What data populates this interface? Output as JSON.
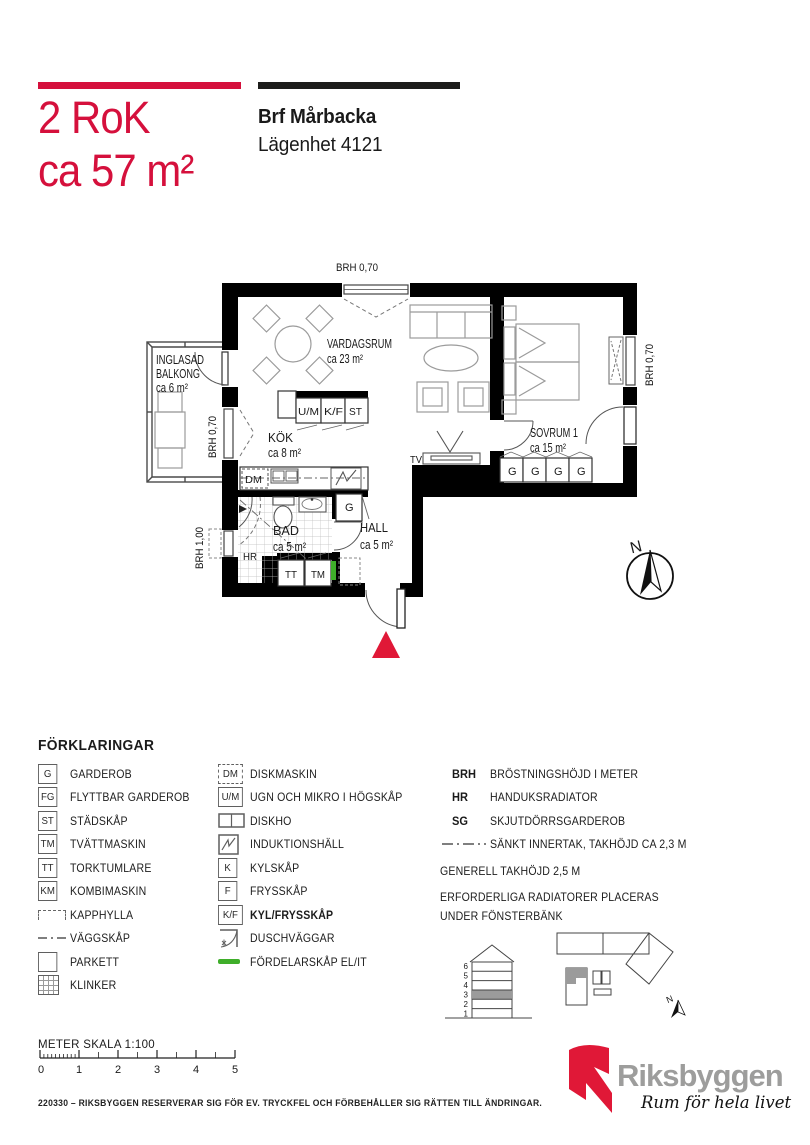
{
  "header": {
    "title_line1": "2 RoK",
    "title_line2": "ca 57 m²",
    "project": "Brf Mårbacka",
    "apartment": "Lägenhet 4121"
  },
  "plan": {
    "brh_top": "BRH 0,70",
    "brh_right": "BRH 0,70",
    "brh_balcony": "BRH 0,70",
    "brh_left": "BRH 1,00",
    "balcony_l1": "INGLASAD",
    "balcony_l2": "BALKONG",
    "balcony_area": "ca 6 m²",
    "vardagsrum": "VARDAGSRUM",
    "vardagsrum_area": "ca 23 m²",
    "kok": "KÖK",
    "kok_area": "ca 8 m²",
    "sovrum": "SOVRUM 1",
    "sovrum_area": "ca 15 m²",
    "bad": "BAD",
    "bad_area": "ca 5 m²",
    "hall": "HALL",
    "hall_area": "ca 5 m²",
    "um": "U/M",
    "kf": "K/F",
    "st": "ST",
    "dm": "DM",
    "tt": "TT",
    "tm": "TM",
    "hr": "HR",
    "g": "G",
    "tv": "TV",
    "north": "N"
  },
  "legend": {
    "title": "FÖRKLARINGAR",
    "col1": [
      {
        "sym": "G",
        "label": "GARDEROB"
      },
      {
        "sym": "FG",
        "label": "FLYTTBAR GARDEROB"
      },
      {
        "sym": "ST",
        "label": "STÄDSKÅP"
      },
      {
        "sym": "TM",
        "label": "TVÄTTMASKIN"
      },
      {
        "sym": "TT",
        "label": "TORKTUMLARE"
      },
      {
        "sym": "KM",
        "label": "KOMBIMASKIN"
      },
      {
        "sym": "",
        "label": "KAPPHYLLA"
      },
      {
        "sym": "",
        "label": "VÄGGSKÅP"
      },
      {
        "sym": "",
        "label": "PARKETT"
      },
      {
        "sym": "",
        "label": "KLINKER"
      }
    ],
    "col2": [
      {
        "sym": "DM",
        "label": "DISKMASKIN"
      },
      {
        "sym": "U/M",
        "label": "UGN OCH MIKRO  I HÖGSKÅP"
      },
      {
        "sym": "",
        "label": "DISKHO"
      },
      {
        "sym": "",
        "label": "INDUKTIONSHÄLL"
      },
      {
        "sym": "K",
        "label": "KYLSKÅP"
      },
      {
        "sym": "F",
        "label": "FRYSSKÅP"
      },
      {
        "sym": "K/F",
        "label": "KYL/FRYSSKÅP"
      },
      {
        "sym": "",
        "label": "DUSCHVÄGGAR"
      },
      {
        "sym": "",
        "label": "FÖRDELARSKÅP EL/IT"
      }
    ],
    "col3": [
      {
        "sym": "BRH",
        "label": "BRÖSTNINGSHÖJD I METER"
      },
      {
        "sym": "HR",
        "label": "HANDUKSRADIATOR"
      },
      {
        "sym": "SG",
        "label": "SKJUTDÖRRSGARDEROB"
      },
      {
        "sym": "",
        "label": "SÄNKT INNERTAK, TAKHÖJD CA 2,3 M"
      }
    ],
    "note1": "GENERELL TAKHÖJD 2,5 M",
    "note2": "ERFORDERLIGA RADIATORER PLACERAS\nUNDER FÖNSTERBÄNK"
  },
  "elevation": {
    "floors": [
      "6",
      "5",
      "4",
      "3",
      "2",
      "1"
    ],
    "mini_north": "N"
  },
  "scale": {
    "label": "METER  SKALA 1:100",
    "ticks": [
      "0",
      "1",
      "2",
      "3",
      "4",
      "5"
    ]
  },
  "footer": {
    "disclaimer": "220330 – RIKSBYGGEN RESERVERAR SIG FÖR EV. TRYCKFEL OCH FÖRBEHÅLLER SIG RÄTTEN TILL ÄNDRINGAR.",
    "logo_text": "Riksbyggen",
    "logo_tagline": "Rum för hela livet"
  },
  "colors": {
    "brand_red": "#d5103c",
    "logo_red": "#e01837",
    "dist_green": "#3fae2a",
    "logo_gray": "#9d9d9c"
  }
}
